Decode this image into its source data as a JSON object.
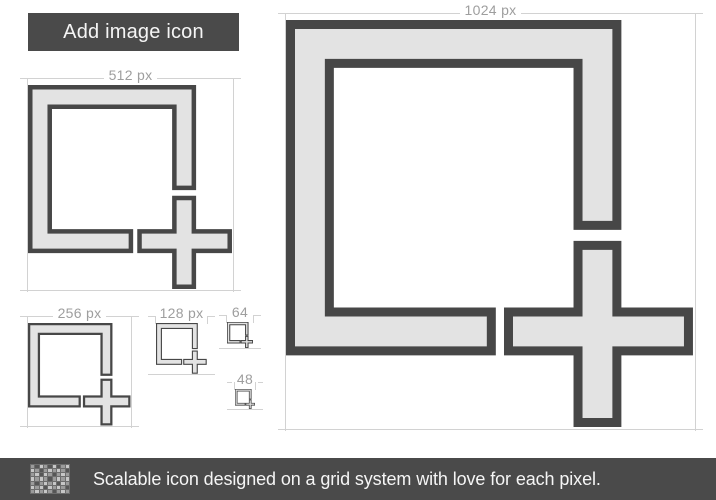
{
  "title": "Add image icon",
  "icon": {
    "name": "add-image-icon",
    "description": "square picture frame with plus sign at bottom-right corner"
  },
  "labels": {
    "s1024": "1024 px",
    "s512": "512 px",
    "s256": "256 px",
    "s128": "128 px",
    "s64": "64",
    "s48": "48"
  },
  "footer": {
    "text": "Scalable icon designed on a grid system with love for each pixel.",
    "icon": "pixel-grid-icon",
    "icon_pattern": [
      "102102012",
      "210121210",
      "120210121",
      "212101212",
      "101212021",
      "212021210",
      "121210121"
    ],
    "icon_colors": {
      "0": "#565656",
      "1": "#9b9b9b",
      "2": "#c7c7c7"
    }
  },
  "colors": {
    "bar_bg": "#4a4a4a",
    "bar_text": "#f5f5f5",
    "icon_outline": "#474747",
    "icon_fill": "#e3e3e3",
    "label_text": "#9e9e9e",
    "guide_line": "#d2d2d2",
    "background": "#ffffff"
  }
}
